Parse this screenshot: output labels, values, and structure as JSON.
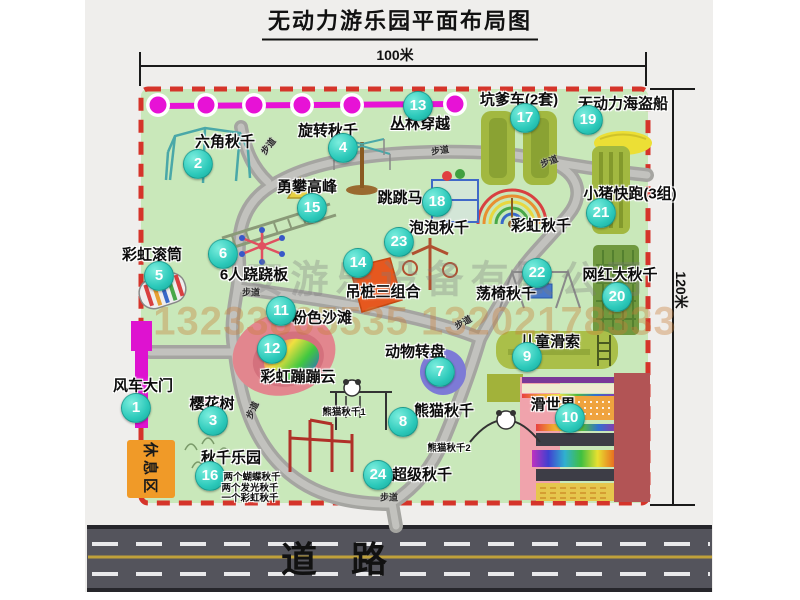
{
  "title": "无动力游乐园平面布局图",
  "dimensions": {
    "width_label": "100米",
    "height_label": "120米"
  },
  "road": {
    "label": "道 路"
  },
  "watermark": {
    "company": "安游乐设备有限公司",
    "phone": "13233805535 13202178333"
  },
  "rest_area": {
    "label": "休息区"
  },
  "path_label": "步道",
  "path_label_positions": [
    {
      "x": 268,
      "y": 146,
      "r": -52
    },
    {
      "x": 440,
      "y": 150,
      "r": -8
    },
    {
      "x": 549,
      "y": 161,
      "r": -20
    },
    {
      "x": 251,
      "y": 292,
      "r": 0
    },
    {
      "x": 463,
      "y": 322,
      "r": -28
    },
    {
      "x": 252,
      "y": 410,
      "r": -65
    },
    {
      "x": 389,
      "y": 497,
      "r": 0
    }
  ],
  "attractions": [
    {
      "num": "1",
      "name": "风车大门",
      "badge": {
        "x": 136,
        "y": 408
      },
      "label": {
        "x": 143,
        "y": 385
      }
    },
    {
      "num": "2",
      "name": "六角秋千",
      "badge": {
        "x": 198,
        "y": 164
      },
      "label": {
        "x": 225,
        "y": 141
      }
    },
    {
      "num": "3",
      "name": "樱花树",
      "badge": {
        "x": 213,
        "y": 421
      },
      "label": {
        "x": 212,
        "y": 403
      }
    },
    {
      "num": "4",
      "name": "旋转秋千",
      "badge": {
        "x": 343,
        "y": 148
      },
      "label": {
        "x": 328,
        "y": 130
      }
    },
    {
      "num": "5",
      "name": "彩虹滚筒",
      "badge": {
        "x": 159,
        "y": 276
      },
      "label": {
        "x": 152,
        "y": 254
      }
    },
    {
      "num": "6",
      "name": "6人跷跷板",
      "badge": {
        "x": 223,
        "y": 254
      },
      "label": {
        "x": 254,
        "y": 274
      }
    },
    {
      "num": "7",
      "name": "动物转盘",
      "badge": {
        "x": 440,
        "y": 372
      },
      "label": {
        "x": 415,
        "y": 351
      }
    },
    {
      "num": "8",
      "name": "熊猫秋千",
      "badge": {
        "x": 403,
        "y": 422
      },
      "label": {
        "x": 444,
        "y": 410
      }
    },
    {
      "num": "9",
      "name": "儿童滑索",
      "badge": {
        "x": 527,
        "y": 357
      },
      "label": {
        "x": 550,
        "y": 341
      }
    },
    {
      "num": "10",
      "name": "滑世界",
      "badge": {
        "x": 570,
        "y": 418
      },
      "label": {
        "x": 553,
        "y": 404
      }
    },
    {
      "num": "11",
      "name": "粉色沙滩",
      "badge": {
        "x": 281,
        "y": 311
      },
      "label": {
        "x": 322,
        "y": 317
      }
    },
    {
      "num": "12",
      "name": "彩虹蹦蹦云",
      "badge": {
        "x": 272,
        "y": 349
      },
      "label": {
        "x": 298,
        "y": 376
      }
    },
    {
      "num": "13",
      "name": "丛林穿越",
      "badge": {
        "x": 418,
        "y": 106
      },
      "label": {
        "x": 420,
        "y": 123
      }
    },
    {
      "num": "14",
      "name": "吊桩三组合",
      "badge": {
        "x": 358,
        "y": 263
      },
      "label": {
        "x": 383,
        "y": 291
      }
    },
    {
      "num": "15",
      "name": "勇攀高峰",
      "badge": {
        "x": 312,
        "y": 208
      },
      "label": {
        "x": 307,
        "y": 186
      }
    },
    {
      "num": "16",
      "name": "秋千乐园",
      "badge": {
        "x": 210,
        "y": 476
      },
      "label": {
        "x": 231,
        "y": 457
      }
    },
    {
      "num": "17",
      "name": "坑爹车(2套)",
      "badge": {
        "x": 525,
        "y": 118
      },
      "label": {
        "x": 519,
        "y": 99
      }
    },
    {
      "num": "18",
      "name": "跳跳马",
      "badge": {
        "x": 437,
        "y": 202
      },
      "label": {
        "x": 400,
        "y": 197
      }
    },
    {
      "num": "19",
      "name": "无动力海盗船",
      "badge": {
        "x": 588,
        "y": 120
      },
      "label": {
        "x": 623,
        "y": 103
      }
    },
    {
      "num": "20",
      "name": "网红大秋千",
      "badge": {
        "x": 617,
        "y": 297
      },
      "label": {
        "x": 620,
        "y": 274
      }
    },
    {
      "num": "21",
      "name": "小猪快跑(3组)",
      "badge": {
        "x": 601,
        "y": 213
      },
      "label": {
        "x": 630,
        "y": 193
      }
    },
    {
      "num": "22",
      "name": "荡椅秋千",
      "badge": {
        "x": 537,
        "y": 273
      },
      "label": {
        "x": 506,
        "y": 293
      }
    },
    {
      "num": "23",
      "name": "泡泡秋千",
      "badge": {
        "x": 399,
        "y": 242
      },
      "label": {
        "x": 439,
        "y": 227
      }
    },
    {
      "num": "24",
      "name": "超级秋千",
      "badge": {
        "x": 378,
        "y": 475
      },
      "label": {
        "x": 422,
        "y": 474
      }
    }
  ],
  "extra_labels": [
    {
      "text": "彩虹秋千",
      "x": 541,
      "y": 225,
      "size": "lg"
    },
    {
      "text": "熊猫秋千1",
      "x": 344,
      "y": 411,
      "size": "sm"
    },
    {
      "text": "熊猫秋千2",
      "x": 449,
      "y": 447,
      "size": "sm"
    },
    {
      "text": "两个蝴蝶秋千",
      "x": 252,
      "y": 476,
      "size": "sm"
    },
    {
      "text": "两个发光秋千",
      "x": 250,
      "y": 487,
      "size": "sm"
    },
    {
      "text": "一个彩虹秋千",
      "x": 250,
      "y": 497,
      "size": "sm"
    }
  ],
  "colors": {
    "map_green": "#c9e8ba",
    "border_red": "#d5342a",
    "badge_teal": "#2cc9ba",
    "chain_magenta": "#e712d6",
    "gate_magenta": "#de12d0",
    "rest_orange": "#f09a28",
    "road_gray": "#54545c",
    "path_gray": "#a5a5a1"
  }
}
